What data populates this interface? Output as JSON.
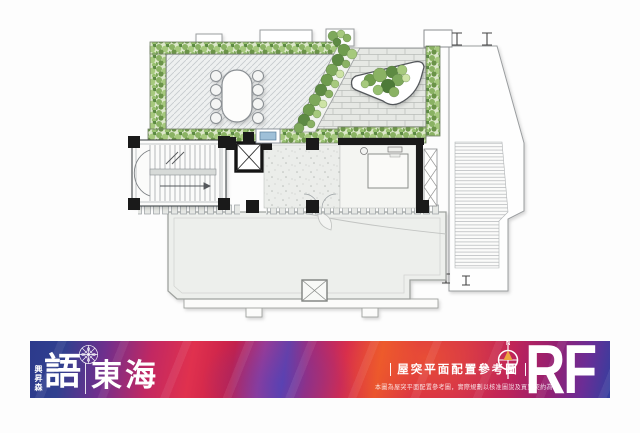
{
  "banner": {
    "developer_name": "興昇森",
    "logo_primary": "語",
    "logo_secondary": "東海",
    "title": "屋突平面配置參考圖",
    "disclaimer": "本圖為屋突平面配置參考圖，實際規劃以核准圖說及買賣契約為準",
    "compass_label": "N",
    "floor_label": "RF",
    "colors": {
      "blue": "#2c3a8c",
      "magenta": "#c22862",
      "red": "#d62a4e",
      "orange": "#e8512f",
      "purple": "#6b2d96",
      "text": "#ffffff"
    }
  },
  "plan": {
    "colors": {
      "greenery_dark": "#5d8a43",
      "greenery_mid": "#8ab263",
      "greenery_light": "#cde3a5",
      "paving_diagonal": "#eef0f0",
      "paving_brick": "#e6e8e4",
      "slab": "#edefec",
      "wall_black": "#1a1a1a",
      "outline": "#9a9d9f",
      "equipment_blue": "#9fc0d8"
    }
  }
}
